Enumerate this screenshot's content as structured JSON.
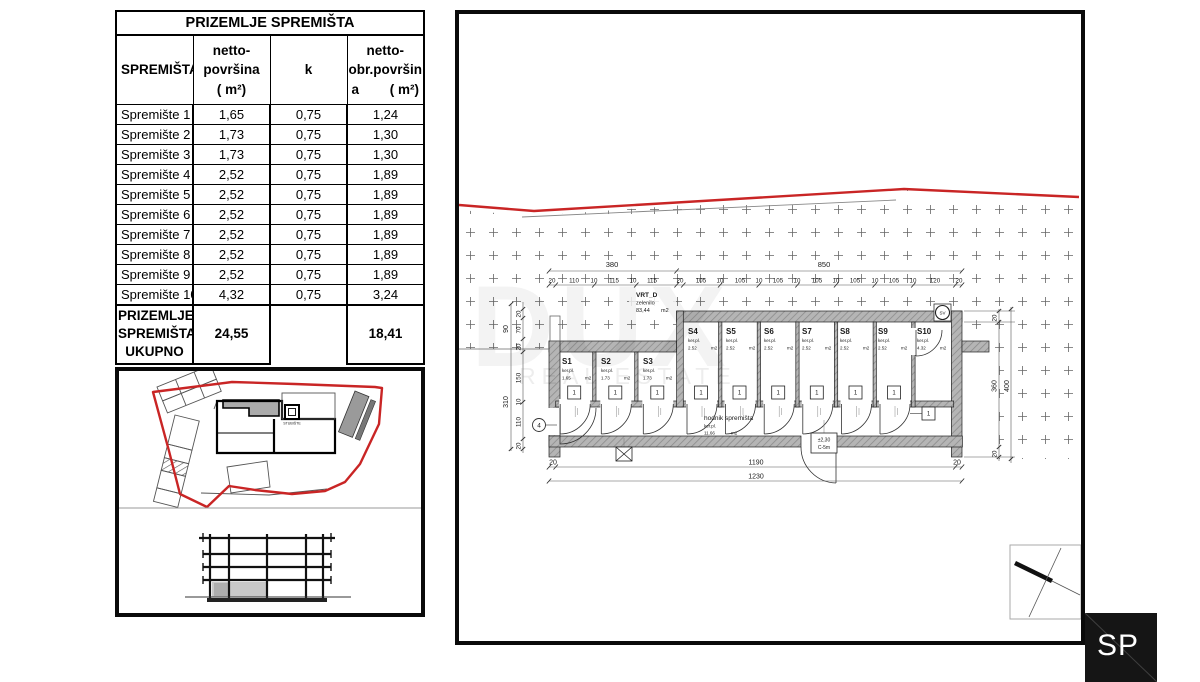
{
  "table": {
    "title": "PRIZEMLJE SPREMIŠTA",
    "col1": "SPREMIŠTA",
    "col2_l1": "netto-",
    "col2_l2": "površina",
    "col2_l3": "( m²)",
    "col3": "k",
    "col4_l1": "netto-",
    "col4_l2": "obr.površin",
    "col4_l3a": "a",
    "col4_l3b": "( m²)",
    "rows": [
      {
        "name": "Spremište 1",
        "netto": "1,65",
        "k": "0,75",
        "obr": "1,24"
      },
      {
        "name": "Spremište 2",
        "netto": "1,73",
        "k": "0,75",
        "obr": "1,30"
      },
      {
        "name": "Spremište 3",
        "netto": "1,73",
        "k": "0,75",
        "obr": "1,30"
      },
      {
        "name": "Spremište 4",
        "netto": "2,52",
        "k": "0,75",
        "obr": "1,89"
      },
      {
        "name": "Spremište 5",
        "netto": "2,52",
        "k": "0,75",
        "obr": "1,89"
      },
      {
        "name": "Spremište 6",
        "netto": "2,52",
        "k": "0,75",
        "obr": "1,89"
      },
      {
        "name": "Spremište 7",
        "netto": "2,52",
        "k": "0,75",
        "obr": "1,89"
      },
      {
        "name": "Spremište 8",
        "netto": "2,52",
        "k": "0,75",
        "obr": "1,89"
      },
      {
        "name": "Spremište 9",
        "netto": "2,52",
        "k": "0,75",
        "obr": "1,89"
      },
      {
        "name": "Spremište 10",
        "netto": "4,32",
        "k": "0,75",
        "obr": "3,24"
      }
    ],
    "total_l1": "PRIZEMLJE",
    "total_l2": "SPREMIŠTA",
    "total_l3": "UKUPNO",
    "total_netto": "24,55",
    "total_obr": "18,41"
  },
  "site": {
    "stubiste": "STUBIŠTE"
  },
  "plan": {
    "garden_name": "VRT_D",
    "garden_sub": "zelenilo",
    "garden_area": "83,44",
    "garden_unit": "m2",
    "units": [
      {
        "id": "S1",
        "sub": "ker.pl.",
        "area": "1.65",
        "unit": "m2"
      },
      {
        "id": "S2",
        "sub": "ker.pl.",
        "area": "1.73",
        "unit": "m2"
      },
      {
        "id": "S3",
        "sub": "ker.pl.",
        "area": "1.73",
        "unit": "m2"
      },
      {
        "id": "S4",
        "sub": "ker.pl.",
        "area": "2.52",
        "unit": "m2"
      },
      {
        "id": "S5",
        "sub": "ker.pl.",
        "area": "2.52",
        "unit": "m2"
      },
      {
        "id": "S6",
        "sub": "ker.pl.",
        "area": "2.52",
        "unit": "m2"
      },
      {
        "id": "S7",
        "sub": "ker.pl.",
        "area": "2.52",
        "unit": "m2"
      },
      {
        "id": "S8",
        "sub": "ker.pl.",
        "area": "2.52",
        "unit": "m2"
      },
      {
        "id": "S9",
        "sub": "ker.pl.",
        "area": "2.52",
        "unit": "m2"
      },
      {
        "id": "S10",
        "sub": "ker.pl.",
        "area": "4.32",
        "unit": "m2"
      }
    ],
    "corridor_name": "hodnik spremišta",
    "corridor_sub": "ker.pl.",
    "corridor_area": "11.66",
    "corridor_unit": "m2",
    "door_no": "1",
    "sv": "SV",
    "bubble": "4",
    "tag_l1": "±2,30",
    "tag_l2": "C-5m",
    "dim_total_left": "380",
    "dim_total_right": "850",
    "top_segments": [
      "20",
      "110",
      "10",
      "115",
      "10",
      "115",
      "20",
      "105",
      "10",
      "105",
      "10",
      "105",
      "10",
      "105",
      "10",
      "105",
      "10",
      "105",
      "10",
      "120",
      "20"
    ],
    "bottom_20a": "20",
    "bottom_1190": "1190",
    "bottom_20b": "20",
    "bottom_total": "1230",
    "left_up_total": "90",
    "left_up": [
      "20",
      "70",
      "20"
    ],
    "left_low_total": "310",
    "left_low": [
      "150",
      "10",
      "110",
      "20"
    ],
    "right_dims": [
      "20",
      "360",
      "400",
      "20"
    ],
    "wm_big": "DUX",
    "wm_small": "REAL ESTATE"
  },
  "logo": {
    "text": "SP"
  }
}
